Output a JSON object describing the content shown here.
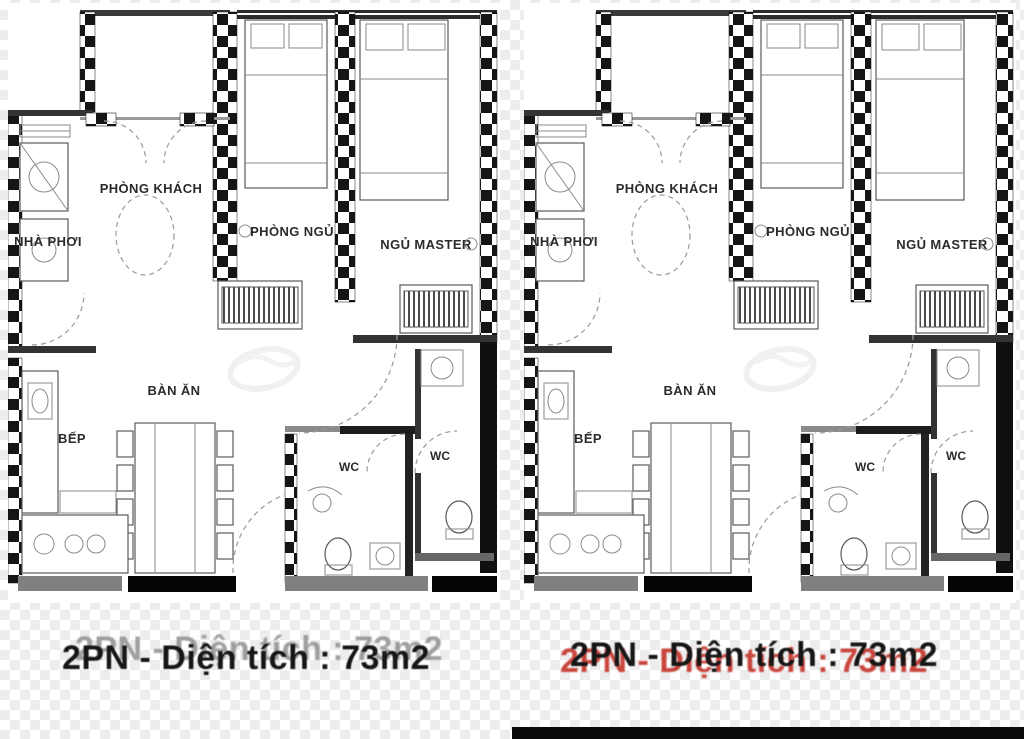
{
  "document": {
    "type": "apartment-floor-plan-listing",
    "plans_count": 2,
    "plans_identical": true
  },
  "rooms": {
    "laundry": "NHÀ PHƠI",
    "living": "PHÒNG KHÁCH",
    "bedroom": "PHÒNG NGỦ",
    "master": "NGỦ MASTER",
    "dining": "BÀN ĂN",
    "kitchen": "BẾP",
    "wc_center": "WC",
    "wc_master": "WC"
  },
  "captions": {
    "left": {
      "text": "2PN - Diện tích : 73m2",
      "ghost_color": "#8f8f8f",
      "main_color": "#161616"
    },
    "right": {
      "text": "2PN - Diện tích : 73m2",
      "ghost_color": "#c0251b",
      "main_color": "#161616"
    }
  },
  "colors": {
    "wall_black": "#151515",
    "wall_gray": "#808080",
    "line_gray": "#5a5a5a",
    "background": "#ffffff",
    "checker_tile": "#ededed",
    "accent_red": "#c0251b"
  }
}
